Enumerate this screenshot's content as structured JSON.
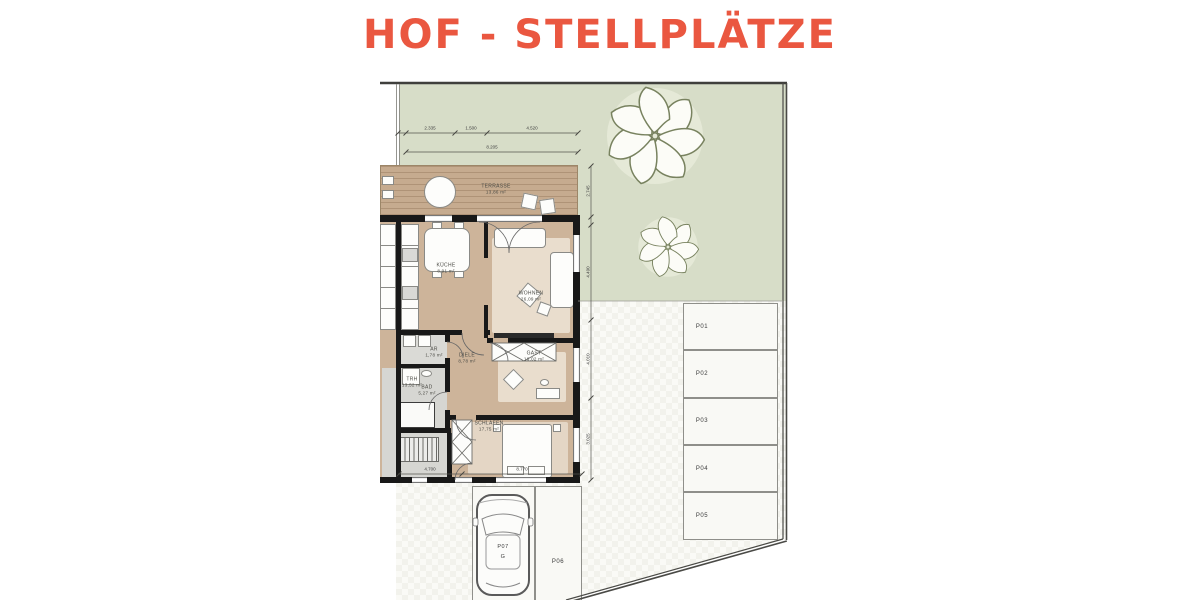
{
  "title": "HOF - STELLPLÄTZE",
  "colors": {
    "title_accent": "#EA5740",
    "garden_green": "#D7DDC8",
    "terrace_wood": "#C6AB8F",
    "interior_wood": "#CDB49A",
    "wet_room_gray": "#D8D8D4",
    "wall_black": "#181818",
    "paving": "#F2F2EC",
    "tree_outline": "#78825F"
  },
  "rooms": {
    "terrasse": {
      "name": "TERRASSE",
      "area": "13,86 m²"
    },
    "kueche": {
      "name": "KÜCHE",
      "area": "8,91 m²"
    },
    "wohnen": {
      "name": "WOHNEN",
      "area": "26,09 m²"
    },
    "ar": {
      "name": "AR",
      "area": "1,78 m²"
    },
    "bad": {
      "name": "BAD",
      "area": "5,27 m²"
    },
    "diele": {
      "name": "DIELE",
      "area": "8,78 m²"
    },
    "gast": {
      "name": "GAST",
      "area": "16,02 m²"
    },
    "schlafen": {
      "name": "SCHLAFEN",
      "area": "17,75 m²"
    },
    "trh": {
      "name": "TRH",
      "area": "13,52 m²"
    }
  },
  "parking": {
    "p01": "P01",
    "p02": "P02",
    "p03": "P03",
    "p04": "P04",
    "p05": "P05",
    "p06": "P06",
    "p07": "P07",
    "p07_sub": "G"
  },
  "dimensions": {
    "top_segments": [
      "2.335",
      "1.500",
      "4.520"
    ],
    "top_total": "8.205",
    "right_segments": [
      "2.745",
      "4.490",
      "4.010",
      "3.025"
    ],
    "bottom_segments": [
      "4.700",
      "8.770"
    ]
  }
}
